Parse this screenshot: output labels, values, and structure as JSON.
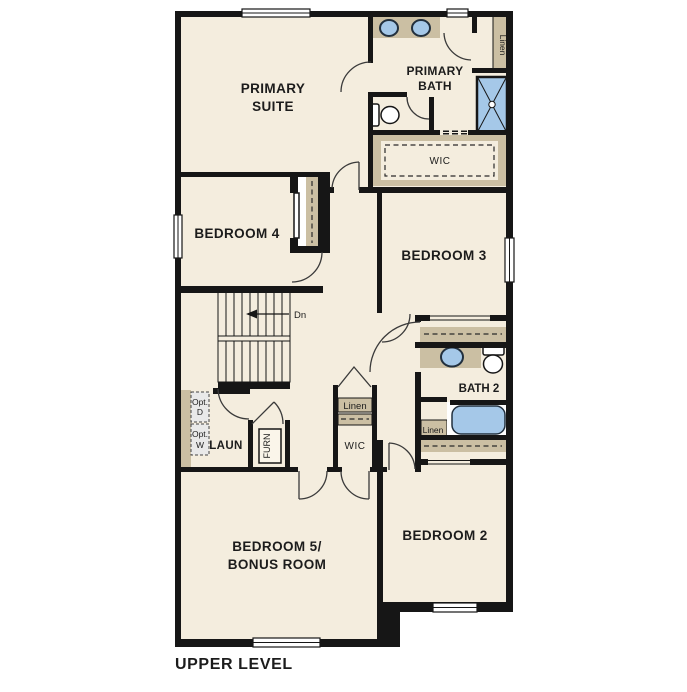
{
  "title": "UPPER LEVEL",
  "rooms": {
    "primary_suite": {
      "label_line1": "PRIMARY",
      "label_line2": "SUITE"
    },
    "primary_bath": {
      "label_line1": "PRIMARY",
      "label_line2": "BATH"
    },
    "bedroom4": {
      "label": "BEDROOM 4"
    },
    "bedroom3": {
      "label": "BEDROOM 3"
    },
    "bedroom2": {
      "label": "BEDROOM 2"
    },
    "bedroom5": {
      "label_line1": "BEDROOM 5/",
      "label_line2": "BONUS ROOM"
    },
    "bath2": {
      "label": "BATH 2"
    },
    "laundry": {
      "label": "LAUN"
    }
  },
  "closets": {
    "linen_primary": "Linen",
    "wic_primary": "WIC",
    "linen_hall": "Linen",
    "wic_hall": "WIC",
    "linen_bath2": "Linen"
  },
  "stairs": {
    "direction_label": "Dn"
  },
  "equipment": {
    "furnace": "FURN",
    "opt_dryer_line1": "Opt.",
    "opt_dryer_line2": "D",
    "opt_washer_line1": "Opt.",
    "opt_washer_line2": "W"
  },
  "colors": {
    "floor": "#f4edde",
    "wall": "#161616",
    "cabinet_tan": "#cbbfa3",
    "fixture_blue": "#a5c8e8",
    "optional_gray": "#e9e9e9"
  }
}
